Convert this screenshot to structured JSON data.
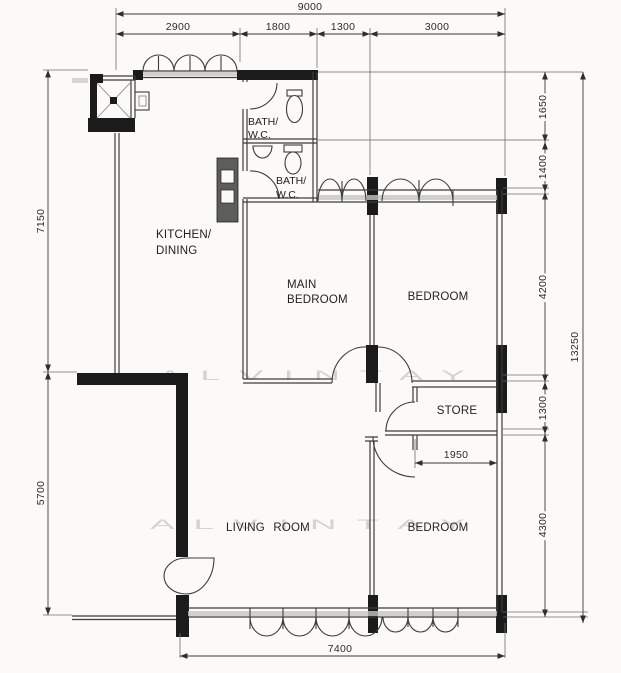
{
  "watermark": "A L V I N    T A Y",
  "rooms": {
    "kitchen1": "KITCHEN/",
    "kitchen2": "DINING",
    "main1": "MAIN",
    "main2": "BEDROOM",
    "bedroom_top": "BEDROOM",
    "bedroom_bottom": "BEDROOM",
    "living": "LIVING ROOM",
    "store": "STORE",
    "bath1a": "BATH/",
    "bath1b": "W.C.",
    "bath2a": "BATH/",
    "bath2b": "W.C."
  },
  "dims": {
    "overall_width": "9000",
    "w1": "2900",
    "w2": "1800",
    "w3": "1300",
    "w4": "3000",
    "left_top": "7150",
    "left_bottom": "5700",
    "r1": "1650",
    "r2": "1400",
    "r3": "4200",
    "r4": "1300",
    "r5": "4300",
    "overall_height": "13250",
    "bottom_width": "7400",
    "store_width": "1950"
  }
}
